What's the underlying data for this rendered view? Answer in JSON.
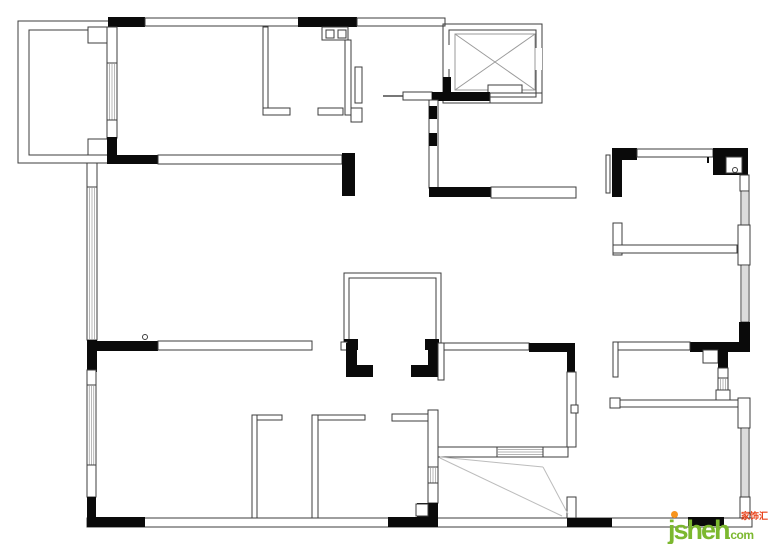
{
  "page": {
    "width": 770,
    "height": 544,
    "background": "#ffffff"
  },
  "watermark": {
    "logo": "jsheh",
    "tld": ".com",
    "cjk": "家饰汇",
    "logo_color": "#7cb82f",
    "cjk_color": "#e8421a",
    "dot_color": "#f7941d"
  },
  "floorplan": {
    "stroke": "#3c3c3c",
    "wall_fill": "#0a0a0a",
    "hatch_color": "#9a9a9a",
    "swing_color": "#bcbcbc",
    "shapes": [
      {
        "t": "o",
        "x": 87,
        "y": 518,
        "w": 665,
        "h": 9,
        "n": "bottom-exterior-wall"
      },
      {
        "t": "o",
        "x": 18,
        "y": 21,
        "w": 92,
        "h": 142,
        "n": "balcony-outer-wall"
      },
      {
        "t": "o",
        "x": 29,
        "y": 30,
        "w": 79,
        "h": 125,
        "n": "balcony-inner-wall"
      },
      {
        "t": "w",
        "x": 88,
        "y": 27,
        "w": 20,
        "h": 16
      },
      {
        "t": "w",
        "x": 88,
        "y": 139,
        "w": 20,
        "h": 16
      },
      {
        "t": "k",
        "x": 108,
        "y": 17,
        "w": 37,
        "h": 10
      },
      {
        "t": "w",
        "x": 145,
        "y": 18,
        "w": 154,
        "h": 8,
        "n": "top-exterior-wall"
      },
      {
        "t": "k",
        "x": 298,
        "y": 17,
        "w": 59,
        "h": 10
      },
      {
        "t": "w",
        "x": 357,
        "y": 18,
        "w": 88,
        "h": 8
      },
      {
        "t": "w",
        "x": 107,
        "y": 27,
        "w": 10,
        "h": 36
      },
      {
        "t": "hv",
        "x": 107,
        "y": 63,
        "w": 10,
        "h": 57,
        "n": "window"
      },
      {
        "t": "w",
        "x": 107,
        "y": 120,
        "w": 10,
        "h": 18
      },
      {
        "t": "k",
        "x": 107,
        "y": 137,
        "w": 10,
        "h": 26
      },
      {
        "t": "k",
        "x": 107,
        "y": 155,
        "w": 51,
        "h": 9
      },
      {
        "t": "w",
        "x": 158,
        "y": 155,
        "w": 184,
        "h": 9,
        "n": "room-divider-sill"
      },
      {
        "t": "k",
        "x": 342,
        "y": 153,
        "w": 13,
        "h": 43
      },
      {
        "t": "w",
        "x": 263,
        "y": 27,
        "w": 5,
        "h": 86,
        "n": "bathroom-wall"
      },
      {
        "t": "w",
        "x": 263,
        "y": 108,
        "w": 27,
        "h": 7
      },
      {
        "t": "w",
        "x": 318,
        "y": 108,
        "w": 25,
        "h": 7
      },
      {
        "t": "w",
        "x": 345,
        "y": 40,
        "w": 6,
        "h": 75
      },
      {
        "t": "w",
        "x": 351,
        "y": 108,
        "w": 11,
        "h": 14
      },
      {
        "t": "w",
        "x": 355,
        "y": 67,
        "w": 7,
        "h": 36,
        "n": "bathroom-door-leaf"
      },
      {
        "t": "w",
        "x": 322,
        "y": 27,
        "w": 26,
        "h": 13,
        "n": "double-sink"
      },
      {
        "t": "o",
        "x": 326,
        "y": 30,
        "w": 8,
        "h": 8
      },
      {
        "t": "o",
        "x": 338,
        "y": 30,
        "w": 8,
        "h": 8
      },
      {
        "t": "o",
        "x": 443,
        "y": 24,
        "w": 99,
        "h": 79,
        "n": "elevator-shaft-outer"
      },
      {
        "t": "o",
        "x": 449,
        "y": 30,
        "w": 87,
        "h": 67,
        "n": "elevator-shaft-inner"
      },
      {
        "t": "b",
        "x": 444,
        "y": 45,
        "w": 7,
        "h": 24
      },
      {
        "t": "b",
        "x": 534,
        "y": 48,
        "w": 8,
        "h": 22
      },
      {
        "t": "x",
        "x": 455,
        "y": 34,
        "w": 80,
        "h": 56,
        "n": "elevator-cab"
      },
      {
        "t": "w",
        "x": 488,
        "y": 85,
        "w": 34,
        "h": 8,
        "n": "elevator-door-sill"
      },
      {
        "t": "l",
        "x1": 383,
        "y1": 96,
        "x2": 403,
        "y2": 96,
        "sw": 2,
        "c": "#777777",
        "n": "entry-door-leaf"
      },
      {
        "t": "w",
        "x": 403,
        "y": 92,
        "w": 29,
        "h": 8,
        "n": "entry-door-frame"
      },
      {
        "t": "k",
        "x": 432,
        "y": 92,
        "w": 58,
        "h": 9
      },
      {
        "t": "o",
        "x": 490,
        "y": 93,
        "w": 52,
        "h": 10
      },
      {
        "t": "k",
        "x": 443,
        "y": 77,
        "w": 8,
        "h": 16
      },
      {
        "t": "w",
        "x": 429,
        "y": 100,
        "w": 9,
        "h": 88,
        "n": "foyer-wall"
      },
      {
        "t": "k",
        "x": 429,
        "y": 106,
        "w": 8,
        "h": 13
      },
      {
        "t": "k",
        "x": 429,
        "y": 133,
        "w": 8,
        "h": 13
      },
      {
        "t": "k",
        "x": 429,
        "y": 187,
        "w": 62,
        "h": 10
      },
      {
        "t": "w",
        "x": 491,
        "y": 187,
        "w": 85,
        "h": 11,
        "n": "hallway-cabinet"
      },
      {
        "t": "w",
        "x": 87,
        "y": 163,
        "w": 10,
        "h": 24
      },
      {
        "t": "hv",
        "x": 87,
        "y": 187,
        "w": 10,
        "h": 153,
        "n": "living-room-window"
      },
      {
        "t": "k",
        "x": 87,
        "y": 340,
        "w": 10,
        "h": 32
      },
      {
        "t": "k",
        "x": 87,
        "y": 341,
        "w": 71,
        "h": 10
      },
      {
        "t": "c",
        "x": 145,
        "y": 337,
        "r": 2.5,
        "n": "door-stop-symbol"
      },
      {
        "t": "w",
        "x": 158,
        "y": 341,
        "w": 154,
        "h": 9,
        "n": "mid-wall-sill"
      },
      {
        "t": "p",
        "pts": "344,345 344,273 441,273 441,345",
        "n": "center-closet-wall"
      },
      {
        "t": "p",
        "pts": "349,345 349,278 436,278 436,345"
      },
      {
        "t": "k",
        "x": 344,
        "y": 339,
        "w": 14,
        "h": 11
      },
      {
        "t": "k",
        "x": 425,
        "y": 339,
        "w": 14,
        "h": 11
      },
      {
        "t": "w",
        "x": 341,
        "y": 342,
        "w": 6,
        "h": 8
      },
      {
        "t": "k",
        "x": 346,
        "y": 343,
        "w": 11,
        "h": 34
      },
      {
        "t": "k",
        "x": 346,
        "y": 365,
        "w": 27,
        "h": 12
      },
      {
        "t": "k",
        "x": 428,
        "y": 343,
        "w": 10,
        "h": 34
      },
      {
        "t": "k",
        "x": 411,
        "y": 365,
        "w": 27,
        "h": 12
      },
      {
        "t": "w",
        "x": 438,
        "y": 343,
        "w": 6,
        "h": 37
      },
      {
        "t": "w",
        "x": 444,
        "y": 343,
        "w": 85,
        "h": 7,
        "n": "dining-sill"
      },
      {
        "t": "k",
        "x": 529,
        "y": 343,
        "w": 43,
        "h": 9
      },
      {
        "t": "k",
        "x": 567,
        "y": 343,
        "w": 8,
        "h": 29
      },
      {
        "t": "w",
        "x": 567,
        "y": 372,
        "w": 9,
        "h": 75
      },
      {
        "t": "w",
        "x": 571,
        "y": 405,
        "w": 7,
        "h": 8
      },
      {
        "t": "w",
        "x": 567,
        "y": 497,
        "w": 9,
        "h": 21
      },
      {
        "t": "k",
        "x": 567,
        "y": 518,
        "w": 45,
        "h": 9
      },
      {
        "t": "w",
        "x": 438,
        "y": 447,
        "w": 59,
        "h": 10,
        "n": "sliding-door-leaf"
      },
      {
        "t": "hh",
        "x": 497,
        "y": 447,
        "w": 46,
        "h": 10,
        "n": "sliding-door-track"
      },
      {
        "t": "w",
        "x": 543,
        "y": 447,
        "w": 25,
        "h": 10,
        "n": "sliding-door-leaf"
      },
      {
        "t": "l",
        "x1": 440,
        "y1": 457,
        "x2": 543,
        "y2": 467,
        "c": "#bcbcbc",
        "n": "door-swing"
      },
      {
        "t": "l",
        "x1": 543,
        "y1": 467,
        "x2": 568,
        "y2": 514,
        "c": "#bcbcbc",
        "n": "door-swing"
      },
      {
        "t": "l",
        "x1": 440,
        "y1": 458,
        "x2": 562,
        "y2": 516,
        "c": "#bcbcbc",
        "n": "door-swing"
      },
      {
        "t": "w",
        "x": 392,
        "y": 414,
        "w": 36,
        "h": 7
      },
      {
        "t": "w",
        "x": 428,
        "y": 410,
        "w": 10,
        "h": 57
      },
      {
        "t": "hv",
        "x": 428,
        "y": 467,
        "w": 10,
        "h": 16,
        "n": "window"
      },
      {
        "t": "w",
        "x": 428,
        "y": 483,
        "w": 10,
        "h": 20
      },
      {
        "t": "k",
        "x": 417,
        "y": 503,
        "w": 21,
        "h": 24
      },
      {
        "t": "w",
        "x": 416,
        "y": 504,
        "w": 12,
        "h": 12
      },
      {
        "t": "k",
        "x": 388,
        "y": 517,
        "w": 50,
        "h": 10
      },
      {
        "t": "w",
        "x": 252,
        "y": 415,
        "w": 30,
        "h": 5
      },
      {
        "t": "w",
        "x": 252,
        "y": 415,
        "w": 5,
        "h": 103,
        "n": "bedroom-partition"
      },
      {
        "t": "w",
        "x": 312,
        "y": 415,
        "w": 53,
        "h": 5
      },
      {
        "t": "w",
        "x": 312,
        "y": 415,
        "w": 6,
        "h": 103,
        "n": "bedroom-partition"
      },
      {
        "t": "w",
        "x": 87,
        "y": 370,
        "w": 9,
        "h": 15
      },
      {
        "t": "hv",
        "x": 87,
        "y": 385,
        "w": 9,
        "h": 80,
        "n": "bedroom-window"
      },
      {
        "t": "w",
        "x": 87,
        "y": 465,
        "w": 9,
        "h": 32
      },
      {
        "t": "k",
        "x": 87,
        "y": 497,
        "w": 9,
        "h": 24
      },
      {
        "t": "k",
        "x": 87,
        "y": 517,
        "w": 58,
        "h": 10
      },
      {
        "t": "o",
        "x": 606,
        "y": 155,
        "w": 4,
        "h": 38,
        "n": "pipe-chase"
      },
      {
        "t": "k",
        "x": 612,
        "y": 148,
        "w": 25,
        "h": 12
      },
      {
        "t": "k",
        "x": 612,
        "y": 160,
        "w": 10,
        "h": 37
      },
      {
        "t": "w",
        "x": 637,
        "y": 149,
        "w": 76,
        "h": 8,
        "n": "bedroom-window-sill"
      },
      {
        "t": "k",
        "x": 707,
        "y": 157,
        "w": 2,
        "h": 6
      },
      {
        "t": "k",
        "x": 713,
        "y": 148,
        "w": 35,
        "h": 27
      },
      {
        "t": "w",
        "x": 726,
        "y": 157,
        "w": 16,
        "h": 16
      },
      {
        "t": "c",
        "x": 735,
        "y": 170,
        "r": 2.5,
        "n": "flue-symbol"
      },
      {
        "t": "w",
        "x": 740,
        "y": 175,
        "w": 9,
        "h": 16
      },
      {
        "t": "hv",
        "x": 741,
        "y": 191,
        "w": 8,
        "h": 34,
        "n": "window"
      },
      {
        "t": "w",
        "x": 738,
        "y": 225,
        "w": 12,
        "h": 40
      },
      {
        "t": "hv",
        "x": 741,
        "y": 265,
        "w": 8,
        "h": 57,
        "n": "window"
      },
      {
        "t": "k",
        "x": 739,
        "y": 322,
        "w": 11,
        "h": 30
      },
      {
        "t": "w",
        "x": 613,
        "y": 223,
        "w": 9,
        "h": 32
      },
      {
        "t": "w",
        "x": 613,
        "y": 245,
        "w": 124,
        "h": 8,
        "n": "ensuite-wall"
      },
      {
        "t": "k",
        "x": 690,
        "y": 342,
        "w": 60,
        "h": 10
      },
      {
        "t": "w",
        "x": 613,
        "y": 342,
        "w": 77,
        "h": 8
      },
      {
        "t": "w",
        "x": 613,
        "y": 342,
        "w": 5,
        "h": 35
      },
      {
        "t": "w",
        "x": 703,
        "y": 350,
        "w": 15,
        "h": 13
      },
      {
        "t": "k",
        "x": 718,
        "y": 350,
        "w": 10,
        "h": 18
      },
      {
        "t": "w",
        "x": 718,
        "y": 368,
        "w": 10,
        "h": 10
      },
      {
        "t": "hv",
        "x": 718,
        "y": 378,
        "w": 10,
        "h": 14,
        "n": "window"
      },
      {
        "t": "w",
        "x": 716,
        "y": 390,
        "w": 14,
        "h": 14
      },
      {
        "t": "w",
        "x": 618,
        "y": 400,
        "w": 122,
        "h": 7,
        "n": "corridor-wall"
      },
      {
        "t": "w",
        "x": 610,
        "y": 398,
        "w": 10,
        "h": 10
      },
      {
        "t": "w",
        "x": 738,
        "y": 398,
        "w": 12,
        "h": 30
      },
      {
        "t": "hv",
        "x": 741,
        "y": 428,
        "w": 8,
        "h": 69,
        "n": "bedroom-window"
      },
      {
        "t": "w",
        "x": 740,
        "y": 497,
        "w": 10,
        "h": 21
      },
      {
        "t": "k",
        "x": 688,
        "y": 517,
        "w": 36,
        "h": 9
      }
    ]
  }
}
